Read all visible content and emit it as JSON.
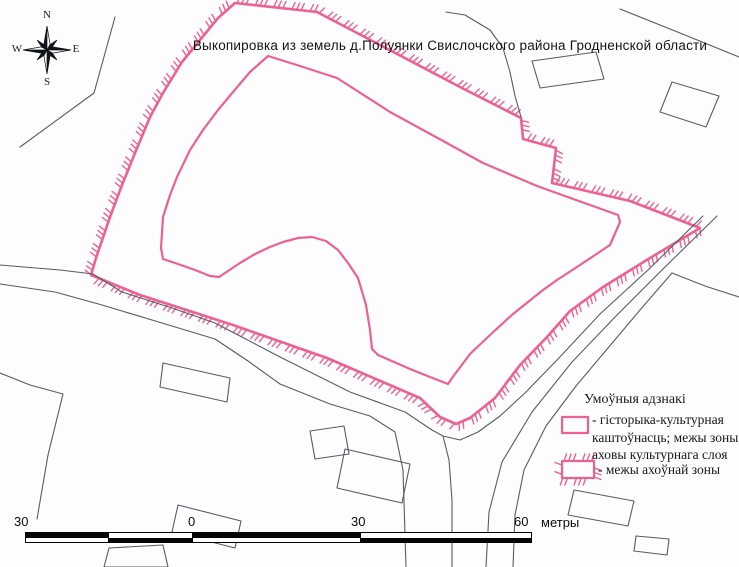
{
  "title": "Выкопировка из земель д.Полуянки Свислочского района Гродненской области",
  "compass": {
    "n": "N",
    "e": "E",
    "s": "S",
    "w": "W"
  },
  "colors": {
    "zone_pink": "#ec6191",
    "map_line": "#565c68",
    "ink": "#141414",
    "bar_black": "#050505",
    "bar_white": "#ffffff"
  },
  "legend": {
    "heading": "Умоўныя адзнакі",
    "items": [
      {
        "symbol": "plain-pink-rect",
        "lines": [
          "- гісторыка-культурная",
          "каштоўнасць; межы зоны",
          "аховы культурнага слоя"
        ]
      },
      {
        "symbol": "hatched-pink-rect",
        "lines": [
          "- межы ахоўнай зоны"
        ]
      }
    ]
  },
  "scalebar": {
    "labels": [
      "30",
      "0",
      "30",
      "60"
    ],
    "unit": "метры",
    "segments": [
      {
        "w": 83,
        "black": "top"
      },
      {
        "w": 84,
        "black": "bottom"
      },
      {
        "w": 168,
        "black": "top"
      },
      {
        "w": 170,
        "black": "bottom"
      }
    ]
  },
  "map": {
    "features": [
      {
        "name": "protection-zone-boundary",
        "stroke": "zone",
        "width": 2.6,
        "closed": true,
        "ticks": true,
        "points": [
          [
            235,
            3
          ],
          [
            317,
            12
          ],
          [
            380,
            45
          ],
          [
            460,
            87
          ],
          [
            521,
            118
          ],
          [
            523,
            139
          ],
          [
            556,
            148
          ],
          [
            552,
            183
          ],
          [
            630,
            201
          ],
          [
            700,
            228
          ],
          [
            650,
            258
          ],
          [
            603,
            287
          ],
          [
            570,
            311
          ],
          [
            547,
            337
          ],
          [
            520,
            365
          ],
          [
            495,
            398
          ],
          [
            470,
            418
          ],
          [
            456,
            424
          ],
          [
            440,
            417
          ],
          [
            420,
            398
          ],
          [
            327,
            358
          ],
          [
            233,
            325
          ],
          [
            140,
            295
          ],
          [
            91,
            275
          ],
          [
            96,
            258
          ],
          [
            110,
            217
          ],
          [
            122,
            185
          ],
          [
            135,
            153
          ],
          [
            150,
            117
          ],
          [
            163,
            93
          ],
          [
            182,
            62
          ],
          [
            200,
            40
          ],
          [
            218,
            18
          ]
        ]
      },
      {
        "name": "cultural-layer-boundary",
        "stroke": "zone",
        "width": 2.2,
        "closed": true,
        "ticks": false,
        "points": [
          [
            268,
            56
          ],
          [
            300,
            66
          ],
          [
            337,
            78
          ],
          [
            390,
            112
          ],
          [
            445,
            142
          ],
          [
            483,
            163
          ],
          [
            537,
            186
          ],
          [
            590,
            205
          ],
          [
            618,
            215
          ],
          [
            620,
            222
          ],
          [
            610,
            245
          ],
          [
            580,
            265
          ],
          [
            557,
            280
          ],
          [
            543,
            290
          ],
          [
            513,
            314
          ],
          [
            490,
            335
          ],
          [
            470,
            354
          ],
          [
            452,
            378
          ],
          [
            448,
            384
          ],
          [
            430,
            377
          ],
          [
            410,
            369
          ],
          [
            378,
            355
          ],
          [
            372,
            349
          ],
          [
            370,
            330
          ],
          [
            366,
            305
          ],
          [
            358,
            278
          ],
          [
            348,
            263
          ],
          [
            338,
            250
          ],
          [
            326,
            241
          ],
          [
            312,
            237
          ],
          [
            298,
            238
          ],
          [
            283,
            242
          ],
          [
            270,
            247
          ],
          [
            255,
            254
          ],
          [
            240,
            263
          ],
          [
            228,
            271
          ],
          [
            219,
            277
          ],
          [
            210,
            276
          ],
          [
            195,
            270
          ],
          [
            178,
            264
          ],
          [
            163,
            259
          ],
          [
            161,
            248
          ],
          [
            163,
            217
          ],
          [
            170,
            195
          ],
          [
            177,
            177
          ],
          [
            190,
            150
          ],
          [
            203,
            130
          ],
          [
            218,
            110
          ],
          [
            233,
            92
          ],
          [
            250,
            72
          ]
        ]
      },
      {
        "name": "legend-cultural-swatch",
        "stroke": "zone",
        "width": 2.2,
        "closed": true,
        "ticks": false,
        "points": [
          [
            562,
            417
          ],
          [
            588,
            417
          ],
          [
            588,
            433
          ],
          [
            562,
            433
          ]
        ]
      },
      {
        "name": "legend-protection-swatch",
        "stroke": "zone",
        "width": 2.2,
        "closed": true,
        "ticks": true,
        "points": [
          [
            562,
            461
          ],
          [
            594,
            461
          ],
          [
            594,
            478
          ],
          [
            562,
            478
          ]
        ]
      },
      {
        "name": "road-edge-sw-upper",
        "stroke": "line",
        "width": 1.1,
        "closed": false,
        "points": [
          [
            0,
            265
          ],
          [
            60,
            270
          ],
          [
            93,
            274
          ],
          [
            122,
            292
          ],
          [
            172,
            308
          ],
          [
            215,
            323
          ],
          [
            280,
            357
          ],
          [
            350,
            392
          ],
          [
            405,
            412
          ],
          [
            432,
            430
          ],
          [
            443,
            436
          ]
        ]
      },
      {
        "name": "road-edge-wrap-ne",
        "stroke": "line",
        "width": 1.1,
        "closed": false,
        "points": [
          [
            443,
            436
          ],
          [
            460,
            440
          ],
          [
            478,
            432
          ],
          [
            500,
            416
          ],
          [
            525,
            393
          ],
          [
            558,
            359
          ],
          [
            600,
            314
          ],
          [
            648,
            270
          ],
          [
            703,
            216
          ]
        ]
      },
      {
        "name": "road-edge-south",
        "stroke": "line",
        "width": 1.1,
        "closed": false,
        "points": [
          [
            443,
            436
          ],
          [
            449,
            460
          ],
          [
            452,
            500
          ],
          [
            452,
            567
          ]
        ]
      },
      {
        "name": "road-edge-sw-lower",
        "stroke": "line",
        "width": 1.1,
        "closed": false,
        "points": [
          [
            0,
            284
          ],
          [
            55,
            292
          ],
          [
            102,
            305
          ],
          [
            152,
            320
          ],
          [
            215,
            339
          ],
          [
            248,
            361
          ],
          [
            280,
            384
          ],
          [
            330,
            404
          ],
          [
            370,
            416
          ],
          [
            395,
            432
          ],
          [
            403,
            470
          ],
          [
            406,
            567
          ]
        ]
      },
      {
        "name": "road-edge-ne-middle",
        "stroke": "line",
        "width": 1.1,
        "closed": false,
        "points": [
          [
            717,
            216
          ],
          [
            664,
            268
          ],
          [
            617,
            315
          ],
          [
            572,
            362
          ],
          [
            532,
            412
          ],
          [
            502,
            462
          ],
          [
            489,
            512
          ],
          [
            486,
            567
          ]
        ]
      },
      {
        "name": "road-edge-ne-outer",
        "stroke": "line",
        "width": 1.1,
        "closed": false,
        "points": [
          [
            672,
            273
          ],
          [
            640,
            310
          ],
          [
            608,
            348
          ],
          [
            576,
            386
          ],
          [
            546,
            426
          ],
          [
            524,
            470
          ],
          [
            515,
            515
          ],
          [
            513,
            567
          ]
        ]
      },
      {
        "name": "road-branch-east",
        "stroke": "line",
        "width": 1.1,
        "closed": false,
        "points": [
          [
            672,
            273
          ],
          [
            705,
            286
          ],
          [
            739,
            297
          ]
        ]
      },
      {
        "name": "road-top-right",
        "stroke": "line",
        "width": 1.1,
        "closed": false,
        "points": [
          [
            620,
            9
          ],
          [
            680,
            33
          ],
          [
            739,
            57
          ]
        ]
      },
      {
        "name": "stream-line",
        "stroke": "line",
        "width": 1.1,
        "closed": false,
        "points": [
          [
            446,
            12
          ],
          [
            465,
            15
          ],
          [
            490,
            30
          ],
          [
            503,
            48
          ],
          [
            510,
            72
          ],
          [
            515,
            96
          ],
          [
            521,
            117
          ]
        ]
      },
      {
        "name": "path-top-left",
        "stroke": "line",
        "width": 1.1,
        "closed": false,
        "points": [
          [
            115,
            17
          ],
          [
            94,
            93
          ],
          [
            20,
            147
          ]
        ]
      },
      {
        "name": "parcel-boundary-sw",
        "stroke": "line",
        "width": 1.1,
        "closed": false,
        "points": [
          [
            0,
            373
          ],
          [
            30,
            385
          ],
          [
            63,
            394
          ],
          [
            48,
            455
          ],
          [
            37,
            519
          ]
        ]
      },
      {
        "name": "building-outline",
        "stroke": "line",
        "width": 1.1,
        "closed": true,
        "points": [
          [
            532,
            61
          ],
          [
            596,
            52
          ],
          [
            604,
            79
          ],
          [
            540,
            88
          ]
        ]
      },
      {
        "name": "building-outline",
        "stroke": "line",
        "width": 1.1,
        "closed": true,
        "points": [
          [
            672,
            82
          ],
          [
            719,
            96
          ],
          [
            706,
            127
          ],
          [
            660,
            112
          ]
        ]
      },
      {
        "name": "building-outline",
        "stroke": "line",
        "width": 1.1,
        "closed": true,
        "points": [
          [
            163,
            363
          ],
          [
            230,
            378
          ],
          [
            227,
            402
          ],
          [
            160,
            387
          ]
        ]
      },
      {
        "name": "building-outline",
        "stroke": "line",
        "width": 1.1,
        "closed": true,
        "points": [
          [
            310,
            431
          ],
          [
            344,
            426
          ],
          [
            349,
            454
          ],
          [
            315,
            459
          ]
        ]
      },
      {
        "name": "building-outline",
        "stroke": "line",
        "width": 1.1,
        "closed": true,
        "points": [
          [
            345,
            449
          ],
          [
            410,
            464
          ],
          [
            402,
            503
          ],
          [
            337,
            488
          ]
        ]
      },
      {
        "name": "building-outline",
        "stroke": "line",
        "width": 1.1,
        "closed": true,
        "points": [
          [
            178,
            505
          ],
          [
            241,
            521
          ],
          [
            235,
            548
          ],
          [
            172,
            532
          ]
        ]
      },
      {
        "name": "building-outline",
        "stroke": "line",
        "width": 1.1,
        "closed": true,
        "points": [
          [
            104,
            567
          ],
          [
            109,
            548
          ],
          [
            163,
            545
          ],
          [
            168,
            567
          ]
        ]
      },
      {
        "name": "building-outline",
        "stroke": "line",
        "width": 1.1,
        "closed": true,
        "points": [
          [
            574,
            490
          ],
          [
            634,
            501
          ],
          [
            628,
            526
          ],
          [
            568,
            515
          ]
        ]
      },
      {
        "name": "building-outline",
        "stroke": "line",
        "width": 1.1,
        "closed": true,
        "points": [
          [
            636,
            536
          ],
          [
            669,
            539
          ],
          [
            667,
            555
          ],
          [
            634,
            551
          ]
        ]
      }
    ]
  }
}
